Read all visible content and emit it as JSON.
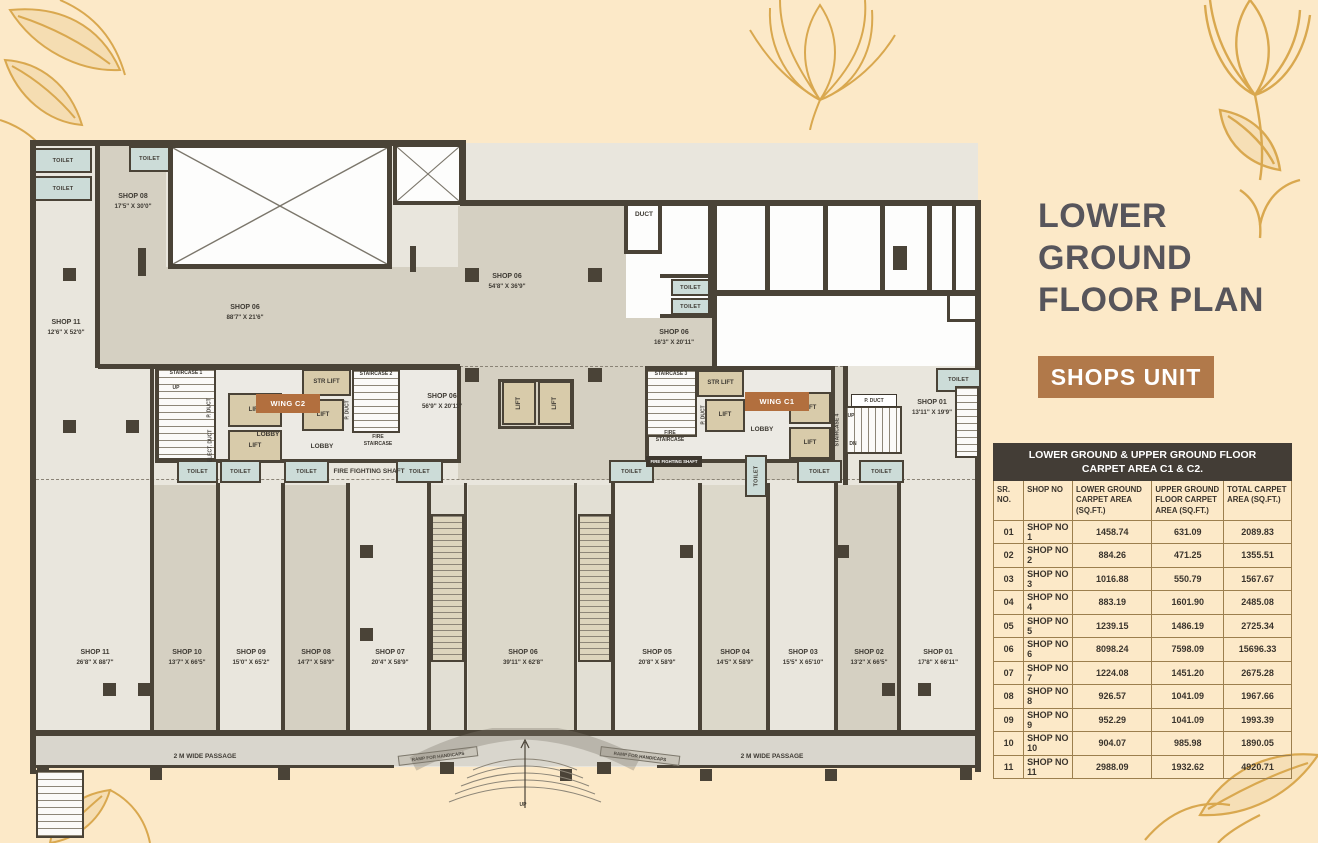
{
  "page": {
    "bg": "#fce9c8",
    "accent_gold": "#d9a84f",
    "accent_brown": "#b1794a",
    "title_color": "#57555b"
  },
  "header": {
    "title_lines": [
      "LOWER",
      "GROUND",
      "FLOOR PLAN"
    ],
    "badge": "SHOPS UNIT"
  },
  "table": {
    "title_line1": "LOWER GROUND & UPPER GROUND FLOOR",
    "title_line2": "CARPET AREA C1 & C2.",
    "columns": [
      "SR. NO.",
      "SHOP NO",
      "LOWER GROUND CARPET AREA (SQ.FT.)",
      "UPPER GROUND FLOOR CARPET AREA (SQ.FT.)",
      "TOTAL CARPET AREA (SQ.FT.)"
    ],
    "rows": [
      [
        "01",
        "SHOP NO 1",
        "1458.74",
        "631.09",
        "2089.83"
      ],
      [
        "02",
        "SHOP NO 2",
        "884.26",
        "471.25",
        "1355.51"
      ],
      [
        "03",
        "SHOP NO 3",
        "1016.88",
        "550.79",
        "1567.67"
      ],
      [
        "04",
        "SHOP NO 4",
        "883.19",
        "1601.90",
        "2485.08"
      ],
      [
        "05",
        "SHOP NO 5",
        "1239.15",
        "1486.19",
        "2725.34"
      ],
      [
        "06",
        "SHOP NO 6",
        "8098.24",
        "7598.09",
        "15696.33"
      ],
      [
        "07",
        "SHOP NO 7",
        "1224.08",
        "1451.20",
        "2675.28"
      ],
      [
        "08",
        "SHOP NO 8",
        "926.57",
        "1041.09",
        "1967.66"
      ],
      [
        "09",
        "SHOP NO 9",
        "952.29",
        "1041.09",
        "1993.39"
      ],
      [
        "10",
        "SHOP NO 10",
        "904.07",
        "985.98",
        "1890.05"
      ],
      [
        "11",
        "SHOP NO 11",
        "2988.09",
        "1932.62",
        "4920.71"
      ]
    ]
  },
  "plan": {
    "items": [
      {
        "id": "toilet-tl-1",
        "l1": "TOILET"
      },
      {
        "id": "toilet-tl-2",
        "l1": "TOILET"
      },
      {
        "id": "toilet-tl-3",
        "l1": "TOILET"
      },
      {
        "id": "toilet-r1",
        "l1": "TOILET"
      },
      {
        "id": "toilet-r2",
        "l1": "TOILET"
      },
      {
        "id": "toilet-m1",
        "l1": "TOILET"
      },
      {
        "id": "toilet-m2",
        "l1": "TOILET"
      },
      {
        "id": "toilet-m3",
        "l1": "TOILET"
      },
      {
        "id": "toilet-m4",
        "l1": "TOILET"
      },
      {
        "id": "toilet-m5",
        "l1": "TOILET"
      },
      {
        "id": "toilet-c1v",
        "l1": "TOILET"
      },
      {
        "id": "toilet-c1a",
        "l1": "TOILET"
      },
      {
        "id": "toilet-c1b",
        "l1": "TOILET"
      },
      {
        "id": "toilet-tr",
        "l1": "TOILET"
      },
      {
        "id": "lift-1",
        "l1": "LIFT"
      },
      {
        "id": "lift-2",
        "l1": "LIFT"
      },
      {
        "id": "lift-3",
        "l1": "LIFT"
      },
      {
        "id": "lift-c1",
        "l1": "LIFT"
      },
      {
        "id": "lift-c2",
        "l1": "LIFT"
      },
      {
        "id": "lift-c3",
        "l1": "LIFT"
      },
      {
        "id": "lift-ctr1",
        "l1": "LIFT"
      },
      {
        "id": "lift-ctr2",
        "l1": "LIFT"
      },
      {
        "id": "strlift-1",
        "l1": "STR LIFT"
      },
      {
        "id": "strlift-2",
        "l1": "STR LIFT"
      },
      {
        "id": "stair-1"
      },
      {
        "id": "stair-2"
      },
      {
        "id": "stair-3"
      },
      {
        "id": "stair-4"
      },
      {
        "id": "stair1-t",
        "l1": "STAIRCASE 1"
      },
      {
        "id": "stair2-t",
        "l1": "STAIRCASE 2"
      },
      {
        "id": "stair3-t",
        "l1": "STAIRCASE 3"
      },
      {
        "id": "stair4-lbl",
        "l1": "STAIRCASE 4"
      },
      {
        "id": "wing-c2",
        "l1": "WING C2"
      },
      {
        "id": "wing-c1",
        "l1": "WING C1"
      },
      {
        "id": "lobby-1",
        "l1": "LOBBY"
      },
      {
        "id": "lobby-2",
        "l1": "LOBBY"
      },
      {
        "id": "lobby-3",
        "l1": "LOBBY"
      },
      {
        "id": "shop08t",
        "l1": "SHOP 08",
        "l2": "17'5\" X 30'0\""
      },
      {
        "id": "shop11t",
        "l1": "SHOP 11",
        "l2": "12'6\" X 52'0\""
      },
      {
        "id": "shop06a",
        "l1": "SHOP 06",
        "l2": "88'7\" X 21'6\""
      },
      {
        "id": "shop06b",
        "l1": "SHOP 06",
        "l2": "54'8\" X 36'9\""
      },
      {
        "id": "shop06c",
        "l1": "SHOP 06",
        "l2": "16'3\" X 20'11\""
      },
      {
        "id": "shop06d",
        "l1": "SHOP 06",
        "l2": "56'9\" X 20'11\""
      },
      {
        "id": "shop01t",
        "l1": "SHOP 01",
        "l2": "13'11\" X 19'9\""
      },
      {
        "id": "duct-t",
        "l1": "DUCT"
      },
      {
        "id": "pduct-1",
        "l1": "P. DUCT"
      },
      {
        "id": "educt-1",
        "l1": "ELECT. DUCT"
      },
      {
        "id": "pduct-2",
        "l1": "P. DUCT"
      },
      {
        "id": "pduct-3",
        "l1": "P. DUCT"
      },
      {
        "id": "pduct-box",
        "l1": "P. DUCT"
      },
      {
        "id": "fire-st-2",
        "l1": "FIRE",
        "l2": "STAIRCASE"
      },
      {
        "id": "fire-st-3",
        "l1": "FIRE",
        "l2": "STAIRCASE"
      },
      {
        "id": "ffs-2",
        "l1": "FIRE FIGHTING SHAFT"
      },
      {
        "id": "ffs-1",
        "l1": "FIRE FIGHTING SHAFT"
      },
      {
        "id": "esc-lbl-1",
        "l1": "ESCALATOR"
      },
      {
        "id": "esc-lbl-2",
        "l1": "ESCALATOR"
      },
      {
        "id": "bshop-11",
        "l1": "SHOP 11",
        "l2": "26'8\" X 88'7\""
      },
      {
        "id": "bshop-10",
        "l1": "SHOP 10",
        "l2": "13'7\" X 66'5\""
      },
      {
        "id": "bshop-09",
        "l1": "SHOP 09",
        "l2": "15'0\" X 65'2\""
      },
      {
        "id": "bshop-08",
        "l1": "SHOP 08",
        "l2": "14'7\" X 58'9\""
      },
      {
        "id": "bshop-07",
        "l1": "SHOP 07",
        "l2": "20'4\" X 58'9\""
      },
      {
        "id": "bshop-06",
        "l1": "SHOP 06",
        "l2": "39'11\" X 62'8\""
      },
      {
        "id": "bshop-05",
        "l1": "SHOP 05",
        "l2": "20'8\" X 58'9\""
      },
      {
        "id": "bshop-04",
        "l1": "SHOP 04",
        "l2": "14'5\" X 58'9\""
      },
      {
        "id": "bshop-03",
        "l1": "SHOP 03",
        "l2": "15'5\" X 65'10\""
      },
      {
        "id": "bshop-02",
        "l1": "SHOP 02",
        "l2": "13'2\" X 66'5\""
      },
      {
        "id": "bshop-01",
        "l1": "SHOP 01",
        "l2": "17'8\" X 66'11\""
      },
      {
        "id": "passage-1",
        "l1": "2  M WIDE PASSAGE"
      },
      {
        "id": "passage-2",
        "l1": "2  M WIDE PASSAGE"
      },
      {
        "id": "ramp-1",
        "l1": "RAMP FOR HANDICAPS"
      },
      {
        "id": "ramp-2",
        "l1": "RAMP FOR HANDICAPS"
      },
      {
        "id": "up-1",
        "l1": "UP"
      },
      {
        "id": "up-2",
        "l1": "UP"
      },
      {
        "id": "up-3",
        "l1": "UP"
      },
      {
        "id": "up-4",
        "l1": "UP"
      },
      {
        "id": "up-s4",
        "l1": "UP"
      },
      {
        "id": "dn-s4",
        "l1": "DN"
      },
      {
        "id": "up-s1",
        "l1": "UP"
      }
    ]
  }
}
